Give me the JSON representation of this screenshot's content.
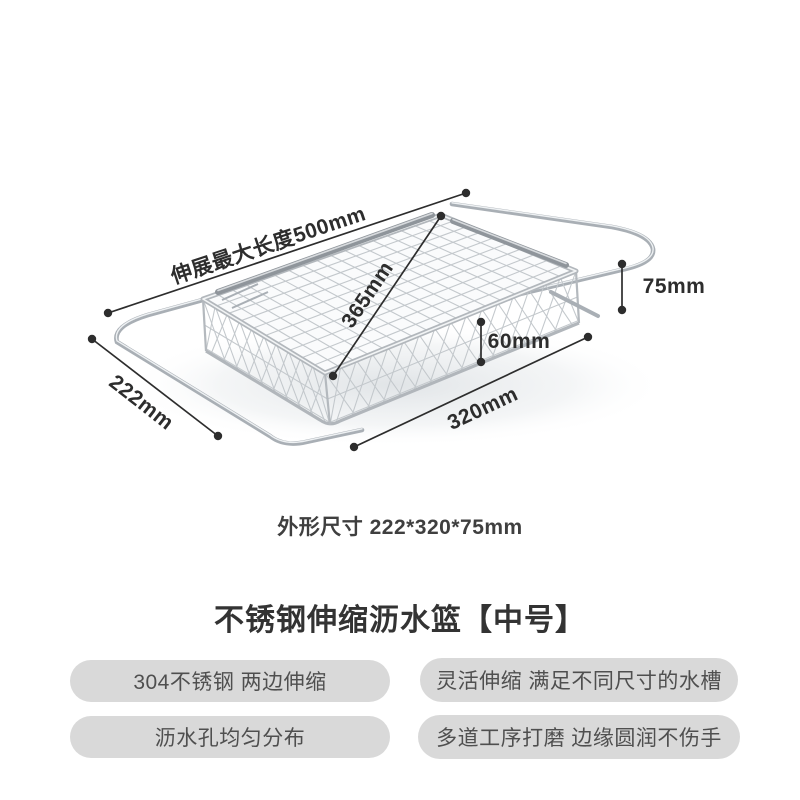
{
  "title": "不锈钢伸缩沥水篮【中号】",
  "spec_line": "外形尺寸 222*320*75mm",
  "annotations": {
    "max_length": "伸展最大长度500mm",
    "diagonal": "365mm",
    "height": "75mm",
    "inner_depth": "60mm",
    "length": "320mm",
    "width": "222mm"
  },
  "features": [
    "304不锈钢 两边伸缩",
    "灵活伸缩 满足不同尺寸的水槽",
    "沥水孔均匀分布",
    "多道工序打磨 边缘圆润不伤手"
  ],
  "colors": {
    "background": "#ffffff",
    "dimension_ink": "#2d2d2d",
    "title_text": "#333333",
    "spec_text": "#3f3f3f",
    "pill_background": "#d9d9d9",
    "pill_text": "#4f4f4f",
    "wire_metal": "#a9afb5",
    "mesh_wire": "#c3c8cc"
  }
}
